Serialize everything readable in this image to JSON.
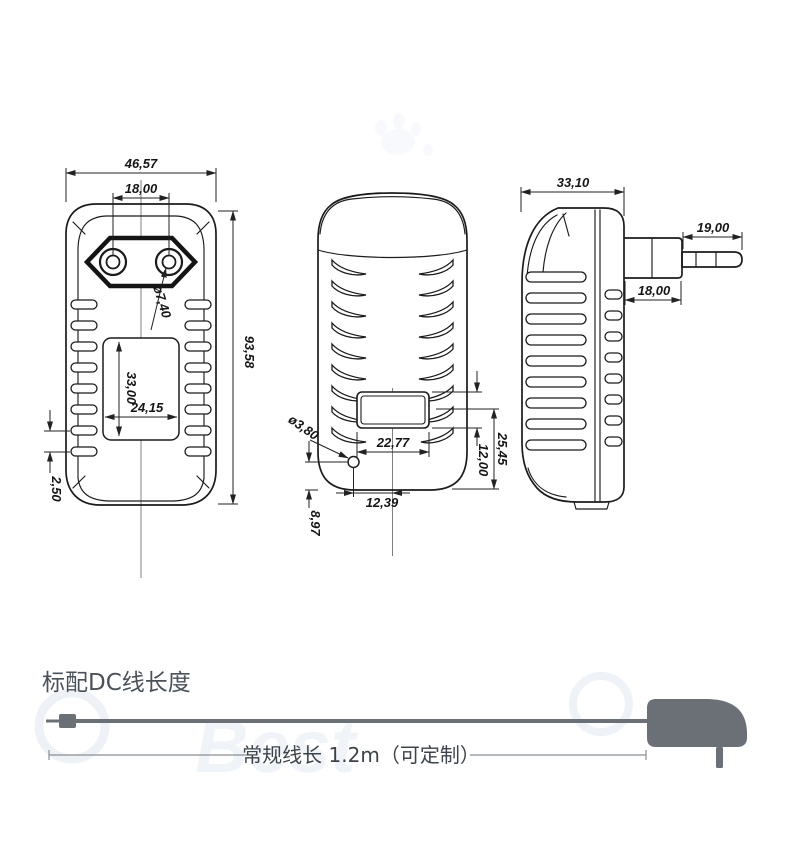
{
  "watermark": {
    "brand": "Best"
  },
  "section": {
    "title": "标配DC线长度",
    "cable_note": "常规线长 1.2m（可定制）"
  },
  "dimensions": {
    "front": {
      "overall_width": "46,57",
      "pin_spacing": "18,00",
      "overall_height": "93,58",
      "pin_diameter": "ø7,40",
      "label_height": "33,00",
      "label_width": "24,15",
      "vent_pitch": "2,50"
    },
    "back": {
      "label_width": "22,77",
      "label_height": "12,00",
      "label_to_bottom": "25,45",
      "hole_diameter": "ø3,80",
      "hole_offset_x": "12,39",
      "hole_offset_y": "8,97"
    },
    "side": {
      "body_depth": "33,10",
      "pin_length": "19,00",
      "plug_depth": "18,00"
    }
  },
  "colors": {
    "line": "#1b1b1b",
    "dimension_text": "#151515",
    "cable_gray": "#6b7076",
    "title_gray": "#4a5159",
    "note_gray": "#3d434a",
    "watermark": "#f0f3f8"
  }
}
